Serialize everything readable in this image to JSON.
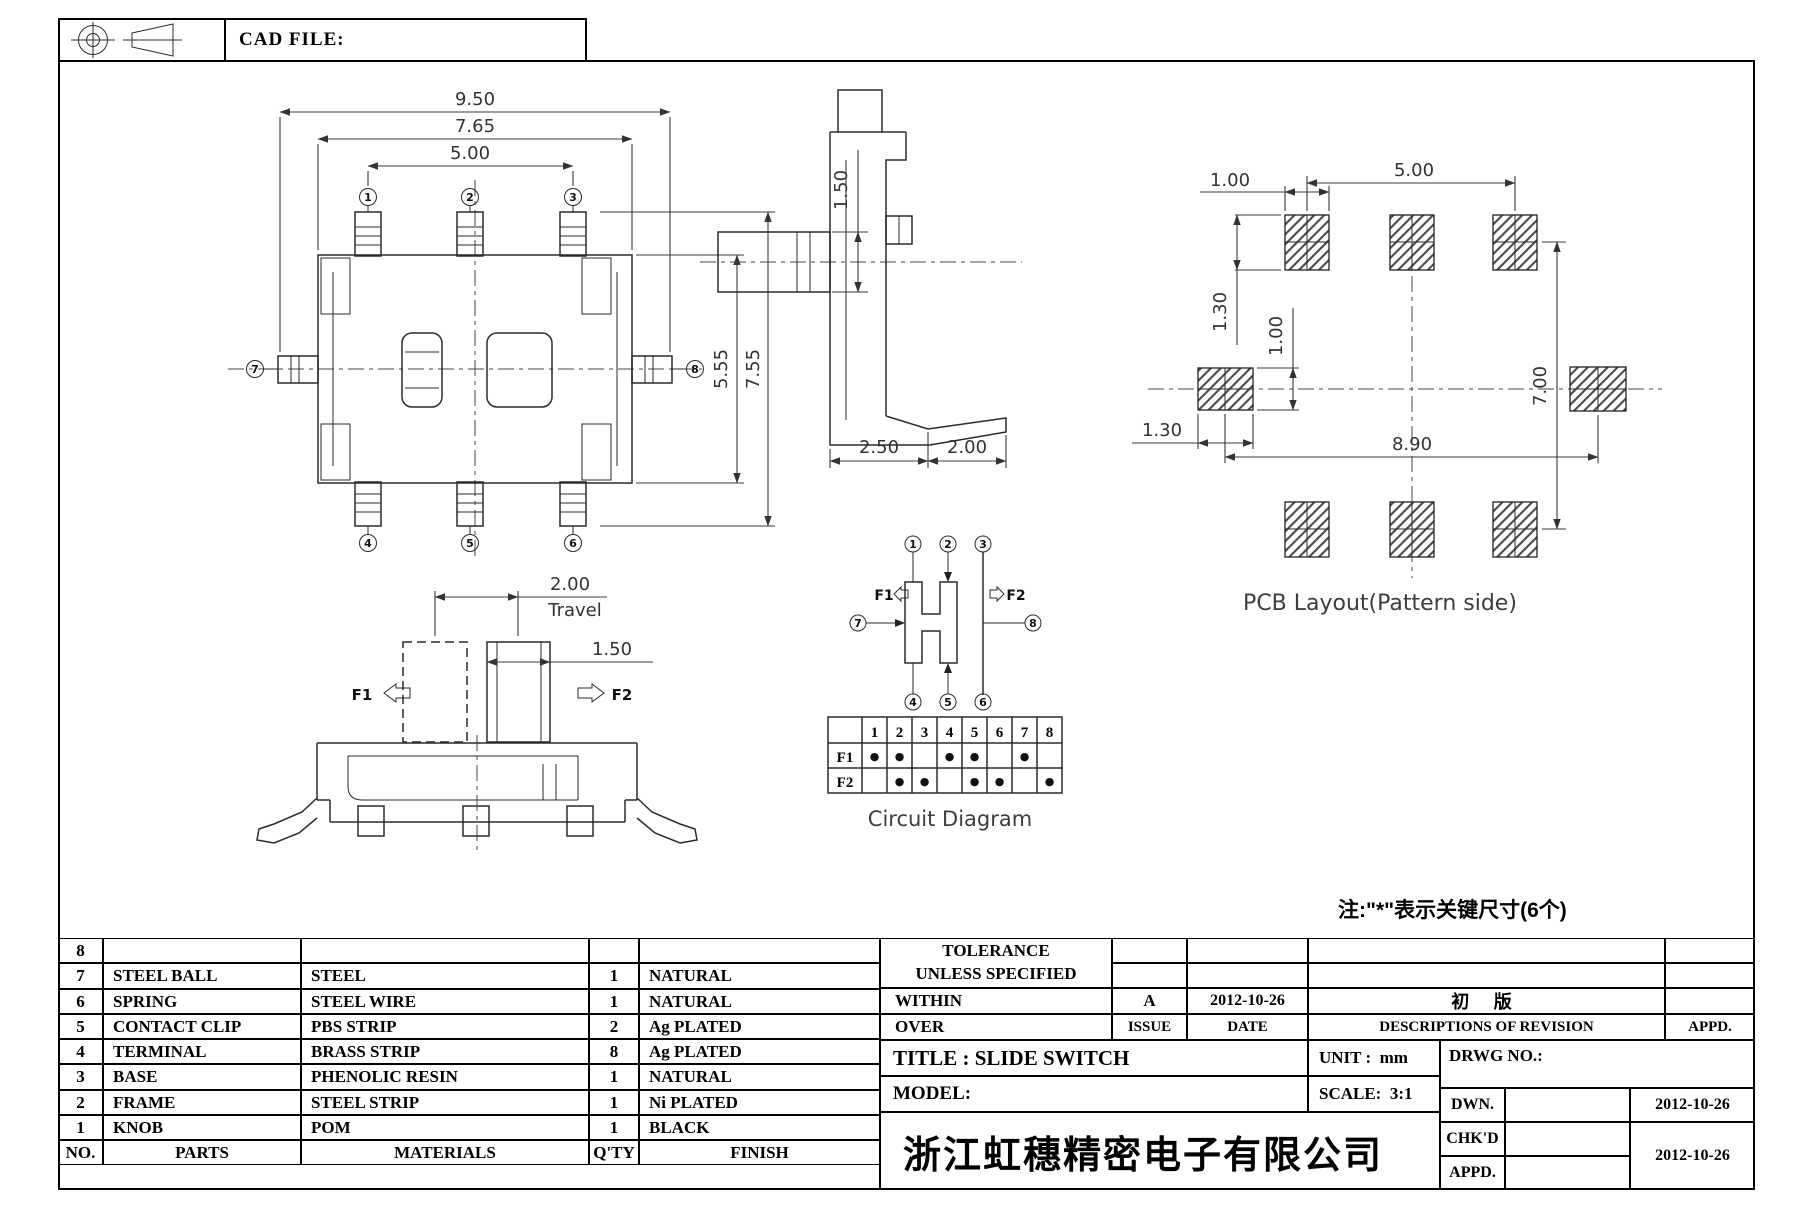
{
  "header": {
    "cad_file_label": "CAD FILE:"
  },
  "pins": [
    "1",
    "2",
    "3",
    "4",
    "5",
    "6",
    "7",
    "8"
  ],
  "top_view": {
    "dim_overall_width": "9.50",
    "dim_frame_width": "7.65",
    "dim_pin_pitch": "5.00",
    "dim_body_height": "5.55",
    "dim_overall_height": "7.55"
  },
  "side_view": {
    "dim_knob_height": "1.50",
    "dim_body_width": "2.50",
    "dim_terminal_ext": "2.00"
  },
  "pcb_layout": {
    "dim_pad_width": "1.00",
    "dim_pad_pitch": "5.00",
    "dim_pad_height": "1.30",
    "dim_side_pad_height": "1.00",
    "dim_side_pad_width": "1.30",
    "dim_pad_span": "8.90",
    "dim_row_pitch": "7.00",
    "caption": "PCB Layout(Pattern side)"
  },
  "travel_view": {
    "dim_travel": "2.00",
    "travel_label": "Travel",
    "dim_knob_width": "1.50",
    "f1_label": "F1",
    "f2_label": "F2"
  },
  "circuit": {
    "f1_label": "F1",
    "f2_label": "F2",
    "caption": "Circuit Diagram",
    "table": {
      "row1_label": "F1",
      "row2_label": "F2",
      "columns": [
        "1",
        "2",
        "3",
        "4",
        "5",
        "6",
        "7",
        "8"
      ],
      "f1_cells": [
        "●",
        "●",
        "",
        "●",
        "●",
        "",
        "●",
        ""
      ],
      "f2_cells": [
        "",
        "●",
        "●",
        "",
        "●",
        "●",
        "",
        "●"
      ]
    }
  },
  "note": "注:\"*\"表示关键尺寸(6个)",
  "parts_table": {
    "headers": {
      "no": "NO.",
      "parts": "PARTS",
      "materials": "MATERIALS",
      "qty": "Q'TY",
      "finish": "FINISH"
    },
    "rows": [
      {
        "no": "8",
        "parts": "",
        "materials": "",
        "qty": "",
        "finish": ""
      },
      {
        "no": "7",
        "parts": "STEEL BALL",
        "materials": "STEEL",
        "qty": "1",
        "finish": "NATURAL"
      },
      {
        "no": "6",
        "parts": "SPRING",
        "materials": "STEEL WIRE",
        "qty": "1",
        "finish": "NATURAL"
      },
      {
        "no": "5",
        "parts": "CONTACT CLIP",
        "materials": "PBS STRIP",
        "qty": "2",
        "finish": "Ag PLATED"
      },
      {
        "no": "4",
        "parts": "TERMINAL",
        "materials": "BRASS STRIP",
        "qty": "8",
        "finish": "Ag PLATED"
      },
      {
        "no": "3",
        "parts": "BASE",
        "materials": "PHENOLIC RESIN",
        "qty": "1",
        "finish": "NATURAL"
      },
      {
        "no": "2",
        "parts": "FRAME",
        "materials": "STEEL STRIP",
        "qty": "1",
        "finish": "Ni PLATED"
      },
      {
        "no": "1",
        "parts": "KNOB",
        "materials": "POM",
        "qty": "1",
        "finish": "BLACK"
      }
    ]
  },
  "title_block": {
    "tolerance_line1": "TOLERANCE",
    "tolerance_line2": "UNLESS SPECIFIED",
    "within_label": "WITHIN",
    "over_label": "OVER",
    "issue_value": "A",
    "issue_date": "2012-10-26",
    "issue_label": "ISSUE",
    "date_label": "DATE",
    "revision_desc": "初 版",
    "revision_header": "DESCRIPTIONS OF REVISION",
    "appd_header": "APPD.",
    "title": "TITLE : SLIDE SWITCH",
    "unit_label": "UNIT :",
    "unit_value": "mm",
    "drwg_label": "DRWG NO.:",
    "model_label": "MODEL:",
    "scale_label": "SCALE:",
    "scale_value": "3:1",
    "dwn_label": "DWN.",
    "dwn_date": "2012-10-26",
    "chkd_label": "CHK'D",
    "appd_label": "APPD.",
    "approval_date": "2012-10-26",
    "company": "浙江虹穗精密电子有限公司"
  }
}
